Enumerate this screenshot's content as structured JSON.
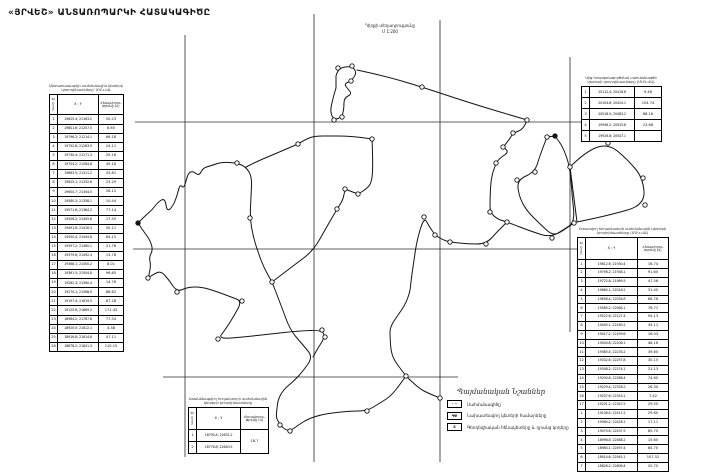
{
  "title": "«ՅՐՎԵՇ» ԱՆՏԱՌՈՊԱՐԿԻ ՀԱՏԱԿԱԳԻԾԸ",
  "note": {
    "line1": "Դիրքի տեղադրությունը",
    "line2": "Մ 1:200"
  },
  "headers": {
    "idx": "Կետի №",
    "xy": "X ; Y",
    "dist": "Հեռավորու- թյունը (մ)"
  },
  "left_table": {
    "caption1": "Անտառապարկի սահմանային կետերի",
    "caption2": "կոորդինատները՝ ՄՍԿ-ՎԱ",
    "rows": [
      [
        "1",
        "19825.4; 21163.2",
        "50.23"
      ],
      [
        "2",
        "19801.6; 21207.5",
        "8.65"
      ],
      [
        "3",
        "19796.2; 21214.1",
        "66.18"
      ],
      [
        "4",
        "19752.8; 21263.9",
        "24-11"
      ],
      [
        "5",
        "19730.4; 21271.3",
        "29.16"
      ],
      [
        "6",
        "19704.2; 21284.6",
        "49.18"
      ],
      [
        "7",
        "19663.5; 21311.2",
        "43.81"
      ],
      [
        "8",
        "19625.1; 21332.8",
        "23.29"
      ],
      [
        "9",
        "19604.7; 21344.5",
        "28.12"
      ],
      [
        "10",
        "19580.3; 21358.1",
        "10.44"
      ],
      [
        "11",
        "19571.6; 21364.2",
        "77.14"
      ],
      [
        "12",
        "19506.2; 21405.8",
        "17.55"
      ],
      [
        "13",
        "19491.8; 21416.3",
        "50.11"
      ],
      [
        "14",
        "19450.4; 21444.6",
        "64.15"
      ],
      [
        "15",
        "19397.2; 21480.1",
        "21.76"
      ],
      [
        "16",
        "19379.6; 21492.4",
        "13.78"
      ],
      [
        "17",
        "19368.1; 21500.2",
        "8.01"
      ],
      [
        "18",
        "19361.5; 21504.8",
        "96.65"
      ],
      [
        "19",
        "19282.3; 21560.4",
        "14.76"
      ],
      [
        "20",
        "19270.1; 21568.9",
        "88.62"
      ],
      [
        "21",
        "19197.4; 21619.5",
        "87.28"
      ],
      [
        "22",
        "19125.6; 21669.2",
        "171.42"
      ],
      [
        "23",
        "18984.2; 21767.8",
        "77.54"
      ],
      [
        "24",
        "18920.5; 21812.1",
        "4.38"
      ],
      [
        "25",
        "18916.8; 21814.6",
        "47.11"
      ],
      [
        "26",
        "18878.2; 21841.3",
        "110.15"
      ]
    ]
  },
  "top_right_table": {
    "caption1": "Կից հողօգտագործման սահմանագծի",
    "caption2": "կետերի կոորդինատները (ՄՍԿ-ՎԱ)",
    "rows": [
      [
        "1",
        "20112.4; 20418.6",
        "9.46"
      ],
      [
        "2",
        "20104.8; 20424.1",
        "104.74"
      ],
      [
        "3",
        "20018.5; 20483.2",
        "88.16"
      ],
      [
        "4",
        "19946.2; 20533.8",
        "23.68"
      ],
      [
        "5",
        "19926.8; 20547.1",
        ""
      ]
    ]
  },
  "right_table": {
    "caption1": "Օտարվող հողամասերի սահմանային կետերի",
    "caption2": "կոորդինատները (ՄՍԿ-ՎԱ)",
    "rows_a": [
      [
        "1",
        "19812.6; 21930.4",
        "16.74"
      ],
      [
        "2",
        "19798.2; 21938.1",
        "91.60"
      ],
      [
        "3",
        "19722.8; 21989.5",
        "47.56"
      ],
      [
        "4",
        "19684.1; 22016.2",
        "31.40"
      ],
      [
        "5",
        "19658.4; 22034.8",
        "88.76"
      ],
      [
        "6",
        "19585.2; 22084.1",
        "76.71"
      ],
      [
        "7",
        "19522.6; 22127.4",
        "94.13"
      ],
      [
        "8",
        "19445.1; 22180.2",
        "34.11"
      ],
      [
        "9",
        "19417.2; 22199.6",
        "16.03"
      ],
      [
        "10",
        "19404.8; 22208.1",
        "48.16"
      ],
      [
        "11",
        "19365.4; 22235.2",
        "39.60"
      ],
      [
        "12",
        "19332.6; 22257.8",
        "30.15"
      ],
      [
        "13",
        "19308.2; 22274.1",
        "21.13"
      ],
      [
        "14",
        "19290.8; 22286.4",
        "74.60"
      ],
      [
        "15",
        "19229.4; 22328.2",
        "26.30"
      ],
      [
        "16",
        "19207.6; 22343.1",
        "7.42"
      ],
      [
        "17",
        "19201.2; 22347.5",
        "29.50"
      ]
    ],
    "rows_b": [
      [
        "1",
        "19108.4; 22411.2",
        "29.60"
      ],
      [
        "2",
        "19084.2; 22428.1",
        "17.11"
      ],
      [
        "3",
        "19070.6; 22437.5",
        "89.70"
      ],
      [
        "4",
        "18996.8; 22488.2",
        "15.60"
      ],
      [
        "5",
        "18984.1; 22497.4",
        "84.70"
      ],
      [
        "6",
        "18914.6; 22545.1",
        "107.52"
      ],
      [
        "7",
        "18826.2; 22606.4",
        "20.70"
      ]
    ]
  },
  "bottom_table": {
    "caption1": "Առանձնացվող հողակտորի սահմանային",
    "caption2": "կետերի կոորդինատները",
    "rows": [
      [
        "1",
        "18790.4; 22631.2"
      ],
      [
        "2",
        "18776.8; 22640.5"
      ]
    ],
    "dist": "18.7"
  },
  "legend": {
    "title": "Պայմանական Նշաններ",
    "items": [
      {
        "symbol": "∙ −",
        "label": "Սահմանագիծը"
      },
      {
        "symbol": "ԳՓ",
        "label": "Նախատեսվող կետերի համարները"
      },
      {
        "symbol": "Տ",
        "label": "Գեոդեզիական հենակետերը և դրանց կոդերը"
      }
    ]
  },
  "map": {
    "grid": {
      "v": [
        [
          185,
          35,
          457
        ],
        [
          314,
          14,
          462
        ],
        [
          440,
          20,
          462
        ],
        [
          570,
          57,
          332
        ]
      ],
      "h": [
        [
          122,
          135,
          662
        ],
        [
          249,
          133,
          577
        ],
        [
          377,
          163,
          458
        ]
      ]
    },
    "paths": [
      {
        "closed": true,
        "pts": [
          [
            336,
            76
          ],
          [
            338,
            68
          ],
          [
            352,
            66
          ],
          [
            357,
            73
          ],
          [
            351,
            81
          ],
          [
            344,
            84
          ],
          [
            348,
            89
          ],
          [
            352,
            94
          ],
          [
            344,
            98
          ],
          [
            344,
            108
          ],
          [
            342,
            117
          ],
          [
            334,
            120
          ],
          [
            330,
            112
          ],
          [
            333,
            98
          ],
          [
            336,
            88
          ]
        ]
      },
      {
        "closed": false,
        "pts": [
          [
            357,
            70
          ],
          [
            385,
            76
          ],
          [
            422,
            87
          ],
          [
            470,
            103
          ],
          [
            527,
            120
          ]
        ]
      },
      {
        "closed": false,
        "pts": [
          [
            527,
            120
          ],
          [
            524,
            129
          ],
          [
            513,
            133
          ],
          [
            509,
            140
          ],
          [
            503,
            147
          ],
          [
            509,
            152
          ],
          [
            500,
            158
          ],
          [
            496,
            163
          ],
          [
            491,
            178
          ],
          [
            490,
            200
          ],
          [
            490,
            212
          ],
          [
            497,
            219
          ],
          [
            507,
            222
          ],
          [
            530,
            231
          ],
          [
            552,
            238
          ],
          [
            574,
            223
          ]
        ]
      },
      {
        "closed": true,
        "pts": [
          [
            547,
            137
          ],
          [
            540,
            155
          ],
          [
            535,
            172
          ],
          [
            517,
            180
          ],
          [
            519,
            196
          ],
          [
            526,
            210
          ],
          [
            540,
            224
          ],
          [
            553,
            236
          ],
          [
            563,
            230
          ],
          [
            575,
            222
          ],
          [
            572,
            195
          ],
          [
            570,
            167
          ],
          [
            563,
            147
          ],
          [
            555,
            136
          ]
        ]
      },
      {
        "closed": true,
        "pts": [
          [
            570,
            167
          ],
          [
            585,
            152
          ],
          [
            608,
            143
          ],
          [
            628,
            160
          ],
          [
            643,
            178
          ],
          [
            645,
            205
          ],
          [
            610,
            215
          ],
          [
            577,
            222
          ]
        ]
      },
      {
        "closed": false,
        "pts": [
          [
            372,
            139
          ],
          [
            373,
            160
          ],
          [
            372,
            183
          ],
          [
            365,
            190
          ],
          [
            358,
            194
          ],
          [
            350,
            191
          ],
          [
            345,
            189
          ],
          [
            343,
            200
          ],
          [
            337,
            209
          ],
          [
            325,
            230
          ],
          [
            313,
            251
          ],
          [
            293,
            266
          ],
          [
            272,
            282
          ]
        ]
      },
      {
        "closed": false,
        "pts": [
          [
            138,
            223
          ],
          [
            146,
            215
          ],
          [
            152,
            210
          ],
          [
            158,
            202
          ],
          [
            165,
            198
          ],
          [
            167,
            212
          ],
          [
            173,
            206
          ],
          [
            177,
            196
          ],
          [
            180,
            184
          ],
          [
            184,
            189
          ],
          [
            188,
            173
          ],
          [
            193,
            171
          ],
          [
            199,
            176
          ],
          [
            203,
            168
          ],
          [
            210,
            166
          ],
          [
            222,
            162
          ],
          [
            237,
            163
          ],
          [
            246,
            167
          ],
          [
            252,
            177
          ],
          [
            251,
            196
          ],
          [
            250,
            218
          ],
          [
            253,
            236
          ],
          [
            258,
            252
          ],
          [
            264,
            268
          ],
          [
            272,
            282
          ]
        ]
      },
      {
        "closed": false,
        "pts": [
          [
            246,
            167
          ],
          [
            258,
            161
          ],
          [
            270,
            156
          ],
          [
            284,
            150
          ],
          [
            298,
            144
          ]
        ]
      },
      {
        "closed": false,
        "pts": [
          [
            298,
            144
          ],
          [
            306,
            139
          ],
          [
            315,
            136
          ],
          [
            330,
            136
          ],
          [
            344,
            136
          ],
          [
            358,
            137
          ],
          [
            372,
            139
          ]
        ]
      },
      {
        "closed": false,
        "pts": [
          [
            138,
            223
          ],
          [
            144,
            232
          ],
          [
            150,
            240
          ],
          [
            153,
            250
          ],
          [
            149,
            257
          ],
          [
            151,
            266
          ],
          [
            148,
            278
          ],
          [
            154,
            274
          ],
          [
            161,
            271
          ],
          [
            169,
            280
          ],
          [
            177,
            292
          ],
          [
            188,
            287
          ],
          [
            202,
            287
          ],
          [
            218,
            292
          ],
          [
            231,
            297
          ],
          [
            242,
            301
          ],
          [
            234,
            316
          ],
          [
            225,
            330
          ],
          [
            218,
            339
          ],
          [
            244,
            337
          ],
          [
            270,
            334
          ],
          [
            298,
            331
          ],
          [
            322,
            330
          ],
          [
            325,
            337
          ],
          [
            318,
            348
          ],
          [
            313,
            357
          ]
        ]
      },
      {
        "closed": false,
        "pts": [
          [
            272,
            282
          ],
          [
            281,
            305
          ],
          [
            290,
            330
          ],
          [
            303,
            345
          ],
          [
            313,
            357
          ],
          [
            303,
            371
          ],
          [
            295,
            380
          ],
          [
            283,
            390
          ],
          [
            278,
            400
          ],
          [
            277,
            408
          ],
          [
            276,
            418
          ],
          [
            280,
            424
          ],
          [
            284,
            429
          ],
          [
            290,
            431
          ],
          [
            300,
            424
          ],
          [
            308,
            419
          ],
          [
            320,
            415
          ],
          [
            332,
            413
          ],
          [
            350,
            411
          ],
          [
            367,
            411
          ],
          [
            380,
            403
          ],
          [
            391,
            396
          ],
          [
            401,
            383
          ],
          [
            406,
            376
          ],
          [
            403,
            372
          ],
          [
            394,
            360
          ],
          [
            391,
            351
          ],
          [
            390,
            337
          ],
          [
            390,
            327
          ],
          [
            398,
            315
          ],
          [
            405,
            305
          ],
          [
            410,
            292
          ],
          [
            411,
            281
          ],
          [
            414,
            260
          ],
          [
            417,
            240
          ],
          [
            424,
            217
          ],
          [
            429,
            226
          ],
          [
            435,
            235
          ],
          [
            443,
            240
          ],
          [
            450,
            242
          ],
          [
            468,
            244
          ],
          [
            486,
            244
          ],
          [
            497,
            232
          ],
          [
            507,
            222
          ]
        ]
      },
      {
        "closed": false,
        "pts": [
          [
            406,
            376
          ],
          [
            418,
            388
          ],
          [
            430,
            394
          ],
          [
            440,
            398
          ]
        ]
      }
    ],
    "vertices": [
      [
        338,
        68,
        0
      ],
      [
        352,
        66,
        0
      ],
      [
        351,
        81,
        0
      ],
      [
        342,
        117,
        0
      ],
      [
        334,
        120,
        0
      ],
      [
        422,
        87,
        0
      ],
      [
        527,
        120,
        0
      ],
      [
        513,
        133,
        0
      ],
      [
        503,
        147,
        0
      ],
      [
        496,
        163,
        0
      ],
      [
        490,
        212,
        0
      ],
      [
        507,
        222,
        0
      ],
      [
        552,
        238,
        0
      ],
      [
        574,
        223,
        0
      ],
      [
        547,
        137,
        0
      ],
      [
        555,
        136,
        1
      ],
      [
        570,
        167,
        0
      ],
      [
        535,
        172,
        0
      ],
      [
        517,
        180,
        0
      ],
      [
        608,
        143,
        0
      ],
      [
        643,
        178,
        0
      ],
      [
        645,
        205,
        0
      ],
      [
        372,
        139,
        0
      ],
      [
        358,
        194,
        0
      ],
      [
        345,
        189,
        0
      ],
      [
        337,
        209,
        0
      ],
      [
        272,
        282,
        0
      ],
      [
        138,
        223,
        1
      ],
      [
        237,
        163,
        0
      ],
      [
        250,
        218,
        0
      ],
      [
        148,
        278,
        0
      ],
      [
        177,
        292,
        0
      ],
      [
        242,
        301,
        0
      ],
      [
        218,
        339,
        0
      ],
      [
        322,
        330,
        0
      ],
      [
        325,
        337,
        0
      ],
      [
        290,
        431,
        0
      ],
      [
        280,
        425,
        0
      ],
      [
        367,
        411,
        0
      ],
      [
        406,
        376,
        0
      ],
      [
        424,
        217,
        0
      ],
      [
        435,
        235,
        0
      ],
      [
        450,
        242,
        0
      ],
      [
        486,
        244,
        0
      ],
      [
        298,
        144,
        0
      ],
      [
        440,
        398,
        0
      ]
    ]
  }
}
